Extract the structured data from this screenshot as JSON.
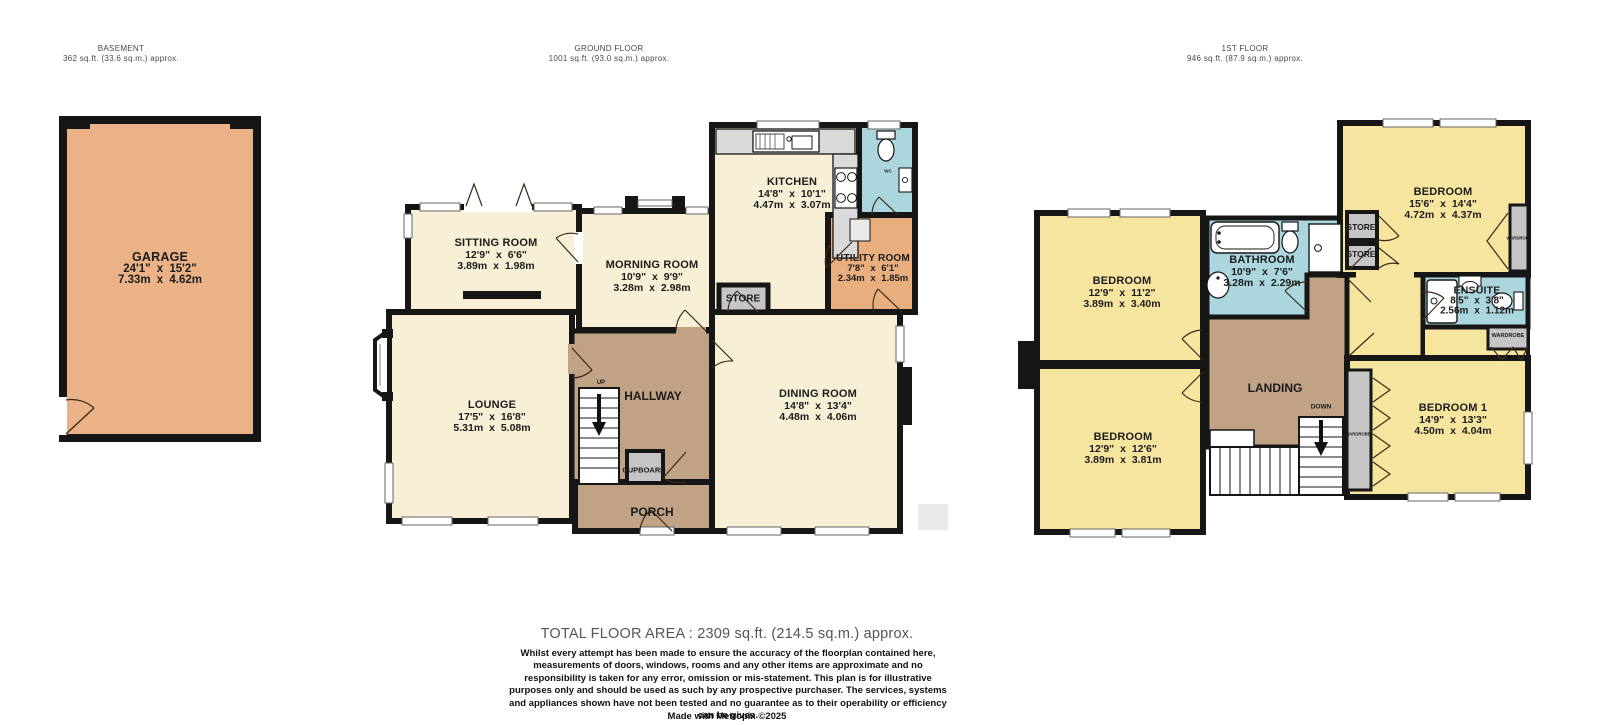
{
  "floors": [
    {
      "id": "basement",
      "title": "BASEMENT",
      "area": "362 sq.ft. (33.6 sq.m.) approx."
    },
    {
      "id": "ground",
      "title": "GROUND FLOOR",
      "area": "1001 sq.ft. (93.0 sq.m.) approx."
    },
    {
      "id": "first",
      "title": "1ST FLOOR",
      "area": "946 sq.ft. (87.9 sq.m.) approx."
    }
  ],
  "rooms": {
    "garage": {
      "name": "GARAGE",
      "imperial": "24'1\" x 15'2\"",
      "metric": "7.33m x 4.62m"
    },
    "sitting_room": {
      "name": "SITTING ROOM",
      "imperial": "12'9\" x 6'6\"",
      "metric": "3.89m x 1.98m"
    },
    "morning_room": {
      "name": "MORNING ROOM",
      "imperial": "10'9\" x 9'9\"",
      "metric": "3.28m x 2.98m"
    },
    "kitchen": {
      "name": "KITCHEN",
      "imperial": "14'8\" x 10'1\"",
      "metric": "4.47m x 3.07m"
    },
    "utility_room": {
      "name": "UTILITY ROOM",
      "imperial": "7'8\" x 6'1\"",
      "metric": "2.34m x 1.85m"
    },
    "lounge": {
      "name": "LOUNGE",
      "imperial": "17'5\" x 16'8\"",
      "metric": "5.31m x 5.08m"
    },
    "dining_room": {
      "name": "DINING ROOM",
      "imperial": "14'8\" x 13'4\"",
      "metric": "4.48m x 4.06m"
    },
    "bedroom_tl": {
      "name": "BEDROOM",
      "imperial": "12'9\" x 11'2\"",
      "metric": "3.89m x 3.40m"
    },
    "bedroom_bl": {
      "name": "BEDROOM",
      "imperial": "12'9\" x 12'6\"",
      "metric": "3.89m x 3.81m"
    },
    "bedroom_tr": {
      "name": "BEDROOM",
      "imperial": "15'6\" x 14'4\"",
      "metric": "4.72m x 4.37m"
    },
    "bedroom_1": {
      "name": "BEDROOM 1",
      "imperial": "14'9\" x 13'3\"",
      "metric": "4.50m x 4.04m"
    },
    "bathroom": {
      "name": "BATHROOM",
      "imperial": "10'9\" x 7'6\"",
      "metric": "3.28m x 2.29m"
    },
    "ensuite": {
      "name": "ENSUITE",
      "imperial": "8'5\" x 3'8\"",
      "metric": "2.56m x 1.12m"
    }
  },
  "labels": {
    "hallway": "HALLWAY",
    "landing": "LANDING",
    "porch": "PORCH",
    "cupboard": "CUPBOARD",
    "store": "STORE",
    "wardrobe": "WARDROBE",
    "wc": "WC",
    "up": "UP",
    "down": "DOWN"
  },
  "footer": {
    "total": "TOTAL FLOOR AREA : 2309 sq.ft. (214.5 sq.m.) approx.",
    "disclaimer": "Whilst every attempt has been made to ensure the accuracy of the floorplan contained here, measurements of doors, windows, rooms and any other items are approximate and no responsibility is taken for any error, omission or mis-statement. This plan is for illustrative purposes only and should be used as such by any prospective purchaser. The services, systems and appliances shown have not been tested and no guarantee as to their operability or efficiency can be given.",
    "credit": "Made with Metropix ©2025"
  },
  "colors": {
    "wall": "#161616",
    "cream_room": "#F7F0D7",
    "yellow_room": "#F6E59F",
    "orange_room": "#E8AE7E",
    "garage": "#EAB286",
    "brown_circulation": "#C0A284",
    "wet_room_blue": "#ABD6DD",
    "closet_gray": "#C5C5C7",
    "counter_gray": "#DADADA",
    "footer_gray": "#555555"
  }
}
